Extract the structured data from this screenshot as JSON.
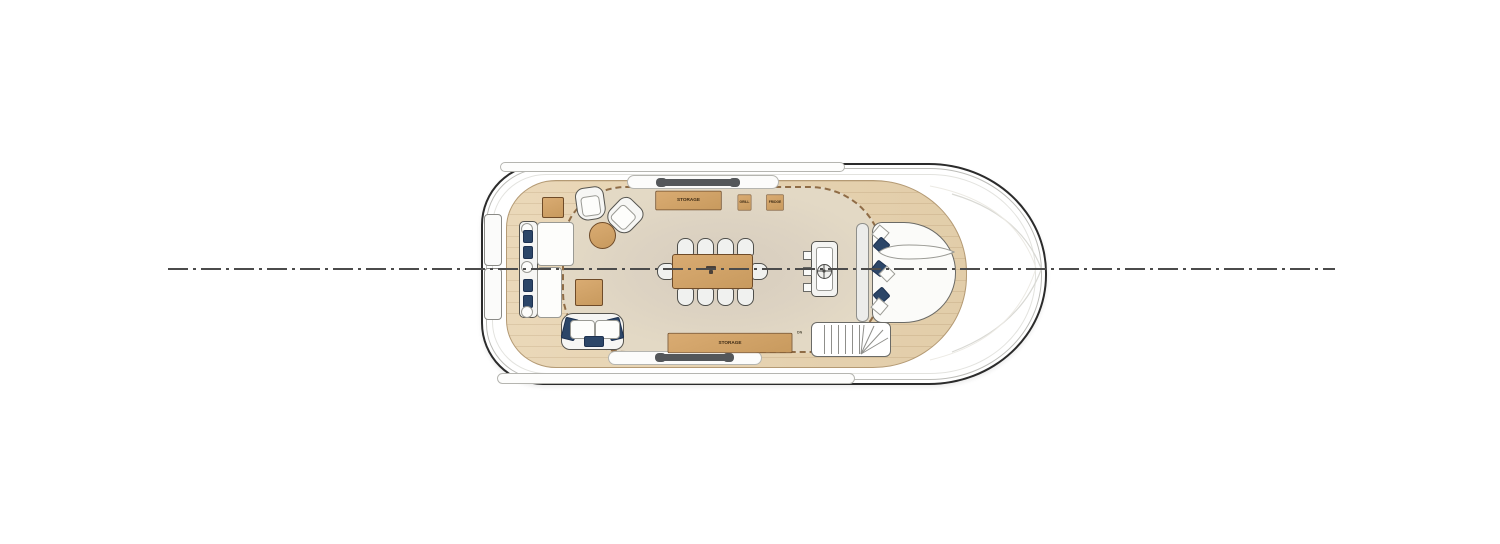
{
  "meta": {
    "title": "Yacht deck plan - top view"
  },
  "deck": {
    "cabinets": {
      "storage_top": "STORAGE",
      "grill": "GRILL",
      "fridge": "FRIDGE",
      "storage_bottom": "STORAGE"
    },
    "stairs": {
      "down_label": "DN"
    },
    "dining": {
      "seat_count": "10"
    },
    "colors": {
      "hull_outline": "#2b2b2b",
      "deck_wood": "#e7d4b4",
      "furniture_wood": "#d2a369",
      "shade_area": "#ddd3c4",
      "upholstery": "#f6f6f4",
      "pillow_navy": "#2c4668",
      "dashed_boundary": "#8f6c46",
      "centerline": "#4b4b4b"
    }
  }
}
